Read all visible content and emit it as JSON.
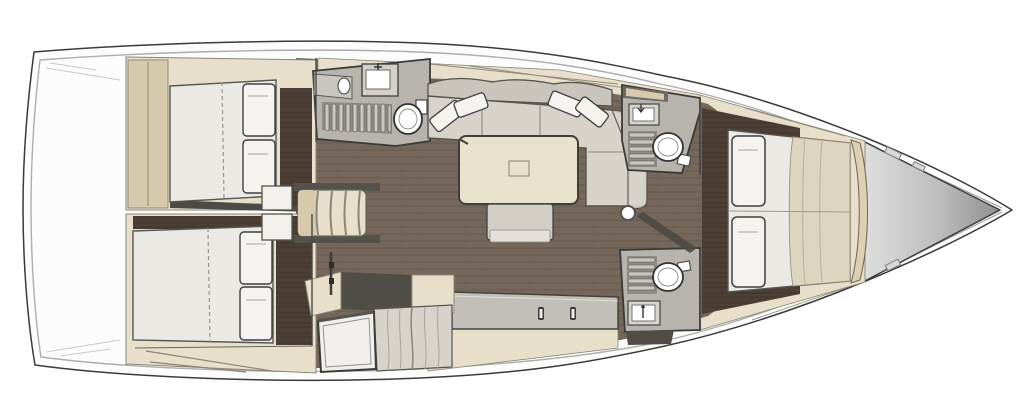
{
  "meta": {
    "title": "Sailboat interior layout floor plan",
    "view": "top-down",
    "orientation": {
      "bow": "right",
      "stern": "left"
    }
  },
  "palette": {
    "hull_fill": "#fcfcfc",
    "hull_stroke": "#4a4a4a",
    "inner_line": "#adadad",
    "beige": "#e7dfc9",
    "beige_dark": "#d6c9ac",
    "beige_line": "#8d8677",
    "wood_salon": "#75675a",
    "wood_salon_line": "#665a4e",
    "wood_dark": "#4c4036",
    "wood_dark_line": "#3f352c",
    "floor_gray": "#b7b4ae",
    "grate_base": "#8e8b85",
    "grate_slat": "#c9c6c0",
    "white_soft": "#f2f0ec",
    "mattress": "#ebe9e4",
    "pillow": "#f4f3f0",
    "sofa": "#d7d3cb",
    "sofa_back": "#c9c5bd",
    "quilt": "#ded5bf",
    "table": "#e9e2cb",
    "ottoman": "#d2cec6",
    "bench": "#c2bfb9",
    "dark": "#3a3a3a",
    "shadow_dark": "#4c4a44",
    "recess": "#504d47",
    "bow_light": "#dedede",
    "bow_dark": "#8f8f8f",
    "fixture_white": "#ffffff"
  },
  "rooms": [
    {
      "name": "aft-cabin-port",
      "features": [
        "double-berth",
        "two-pillows",
        "wardrobe"
      ]
    },
    {
      "name": "aft-cabin-starboard",
      "features": [
        "double-berth",
        "two-pillows"
      ]
    },
    {
      "name": "aft-head",
      "features": [
        "sink",
        "counter",
        "shower-grate",
        "toilet"
      ]
    },
    {
      "name": "companionway",
      "features": [
        "four-steps",
        "lockers"
      ]
    },
    {
      "name": "salon",
      "features": [
        "u-sofa",
        "four-pillows",
        "dining-table",
        "ottoman",
        "sideboard-bench"
      ]
    },
    {
      "name": "galley",
      "features": [
        "counter",
        "fridge-door",
        "recess"
      ]
    },
    {
      "name": "forward-head-port",
      "features": [
        "sink",
        "shower-grate",
        "toilet"
      ]
    },
    {
      "name": "forward-head-starboard",
      "features": [
        "shower-grate",
        "toilet",
        "sink"
      ]
    },
    {
      "name": "owner-cabin",
      "features": [
        "island-berth",
        "two-pillows",
        "quilt"
      ]
    },
    {
      "name": "bow-anchor-locker",
      "features": [
        "triangular-locker",
        "deck-hardware"
      ]
    },
    {
      "name": "mast-post",
      "features": [
        "white-post"
      ]
    }
  ]
}
